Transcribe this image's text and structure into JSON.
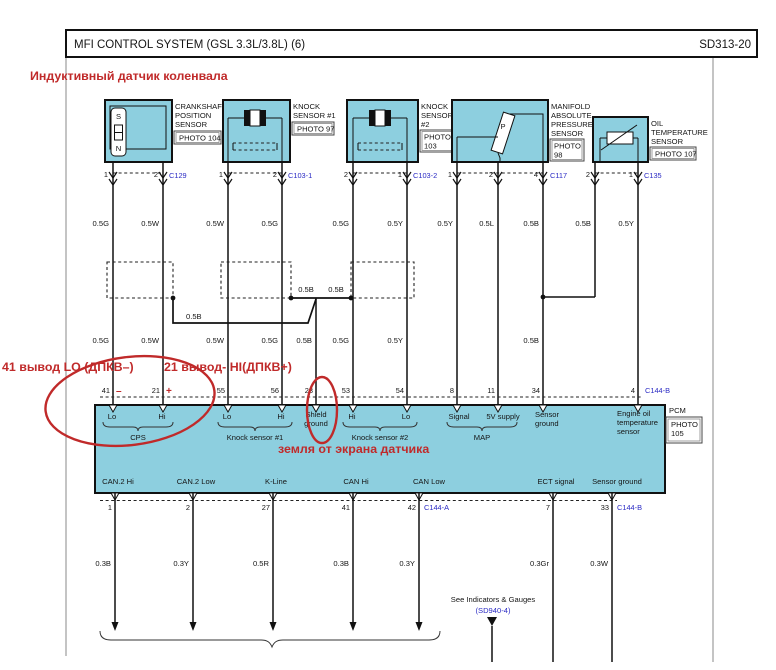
{
  "colors": {
    "box_fill": "#8dcfdf",
    "annotation_red": "#c02a2a",
    "connector_blue": "#2b2bc4"
  },
  "header": {
    "title": "MFI CONTROL SYSTEM (GSL 3.3L/3.8L) (6)",
    "code": "SD313-20"
  },
  "red_notes": {
    "top": "Индуктивный датчик коленвала",
    "pin41": "41 вывод LO (ДПКВ–)",
    "pin21": "21 вывод- HI(ДПКВ+)",
    "minus": "–",
    "plus": "+",
    "ground": "земля от экрана датчика"
  },
  "sensors": [
    {
      "lines": [
        "CRANKSHAFT",
        "POSITION",
        "SENSOR"
      ],
      "photo": [
        "PHOTO 104"
      ],
      "connector": "C129",
      "pins": [
        "1",
        "2"
      ],
      "symbol": {
        "s": "S",
        "n": "N"
      }
    },
    {
      "lines": [
        "KNOCK",
        "SENSOR #1"
      ],
      "photo": [
        "PHOTO 97"
      ],
      "connector": "C103-1",
      "pins": [
        "1",
        "2"
      ]
    },
    {
      "lines": [
        "KNOCK",
        "SENSOR",
        "#2"
      ],
      "photo": [
        "PHOTO",
        "103"
      ],
      "connector": "C103-2",
      "pins": [
        "2",
        "1"
      ]
    },
    {
      "lines": [
        "MANIFOLD",
        "ABSOLUTE",
        "PRESSURE",
        "SENSOR"
      ],
      "photo": [
        "PHOTO",
        "98"
      ],
      "connector": "C117",
      "pins": [
        "1",
        "2",
        "4"
      ],
      "symbol": {
        "p": "P"
      }
    },
    {
      "lines": [
        "OIL",
        "TEMPERATURE",
        "SENSOR"
      ],
      "photo": [
        "PHOTO 107"
      ],
      "connector": "C135",
      "pins": [
        "2",
        "1"
      ]
    }
  ],
  "wires": {
    "row1": [
      "0.5G",
      "0.5W",
      "0.5W",
      "0.5G",
      "0.5G",
      "0.5Y",
      "0.5Y",
      "0.5L",
      "0.5B",
      "0.5B",
      "0.5Y"
    ],
    "shield_bus": [
      "0.5B",
      "0.5B"
    ],
    "shield_detour": "0.5B",
    "row2": [
      "0.5G",
      "0.5W",
      "0.5W",
      "0.5G",
      "0.5B",
      "0.5G",
      "0.5Y",
      "0.5B"
    ],
    "bottom": [
      "0.3B",
      "0.3Y",
      "0.5R",
      "0.3B",
      "0.3Y",
      "0.3Gr",
      "0.3W"
    ]
  },
  "pcm": {
    "top_pins": [
      "41",
      "21",
      "55",
      "56",
      "23",
      "53",
      "54",
      "8",
      "11",
      "34",
      "4"
    ],
    "top_connector": "C144-B",
    "cps": {
      "a": "Lo",
      "b": "Hi",
      "name": "CPS"
    },
    "k1": {
      "a": "Lo",
      "b": "Hi",
      "name": "Knock sensor #1"
    },
    "shield": {
      "l1": "Shield",
      "l2": "ground"
    },
    "k2": {
      "a": "Hi",
      "b": "Lo",
      "name": "Knock sensor #2"
    },
    "map": {
      "a": "Signal",
      "b": "5V supply",
      "name": "MAP"
    },
    "sensor_ground": {
      "l1": "Sensor",
      "l2": "ground"
    },
    "oil": {
      "l1": "Engine oil",
      "l2": "temperature",
      "l3": "sensor"
    },
    "name": "PCM",
    "photo": [
      "PHOTO",
      "105"
    ],
    "bottom_labels": [
      "CAN.2 Hi",
      "CAN.2 Low",
      "K-Line",
      "CAN Hi",
      "CAN Low",
      "ECT signal",
      "Sensor ground"
    ],
    "bottom_pins": [
      "1",
      "2",
      "27",
      "41",
      "42",
      "7",
      "33"
    ],
    "conn_a": "C144-A",
    "conn_b": "C144-B"
  },
  "footer": {
    "see": "See Indicators & Gauges",
    "ref": "(SD940-4)"
  }
}
